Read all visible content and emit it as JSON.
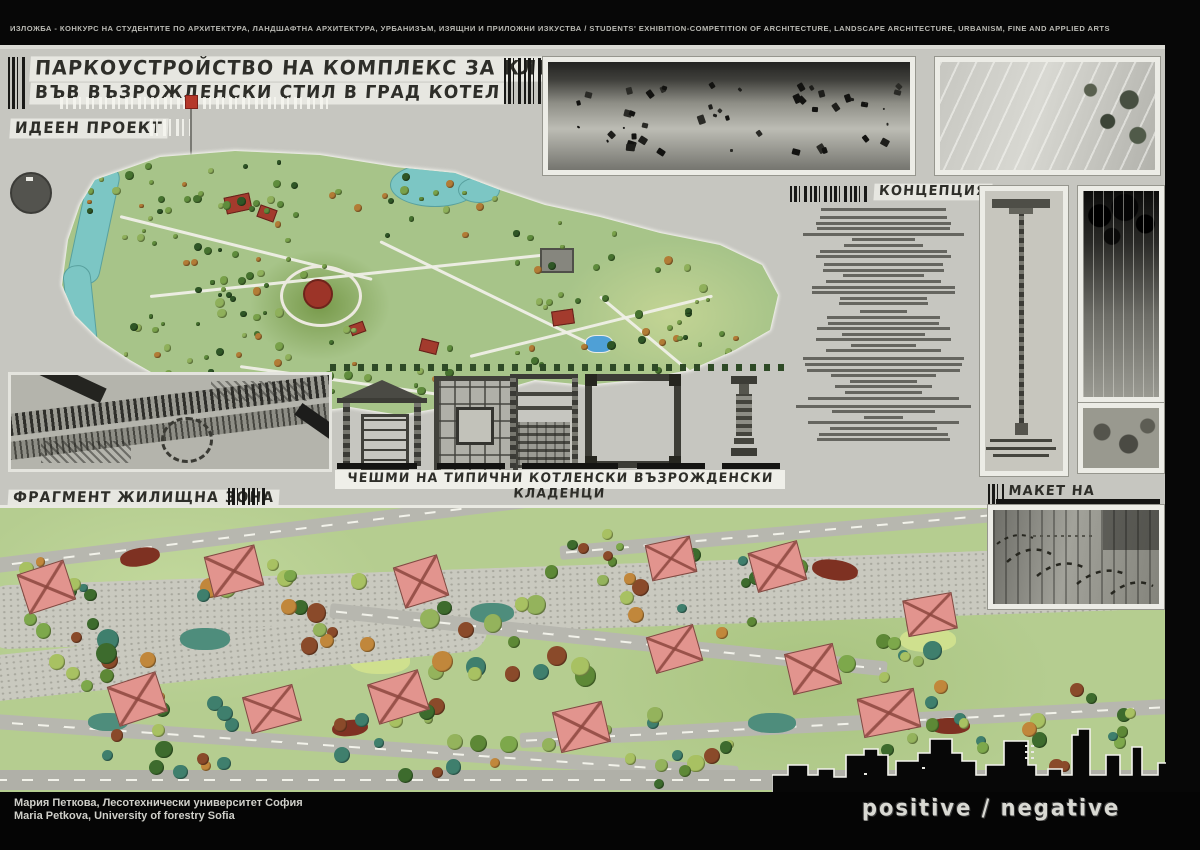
{
  "header": {
    "competition_line": "ИЗЛОЖБА - КОНКУРС НА СТУДЕНТИТЕ ПО АРХИТЕКТУРА, ЛАНДШАФТНА АРХИТЕКТУРА, УРБАНИЗЪМ, ИЗЯЩНИ И ПРИЛОЖНИ ИЗКУСТВА / STUDENTS' EXHIBITION-COMPETITION OF ARCHITECTURE, LANDSCAPE ARCHITECTURE, URBANISM, FINE AND APPLIED ARTS"
  },
  "title": {
    "line1": "ПАРКОУСТРОЙСТВО НА КОМПЛЕКС ЗА КЛИМАТОЛЕЧЕНИЕ",
    "line2": "ВЪВ ВЪЗРОЖДЕНСКИ СТИЛ В ГРАД КОТЕЛ"
  },
  "labels": {
    "master_plan": "ИДЕЕН ПРОЕКТ",
    "concept_heading": "КОНЦЕПЦИЯ",
    "wells_caption": "ЧЕШМИ НА ТИПИЧНИ КОТЛЕНСКИ ВЪЗРОЖДЕНСКИ КЛАДЕНЦИ",
    "fragment": "ФРАГМЕНТ ЖИЛИЩНА ЗОНА",
    "model": "МАКЕТ НА КОМПЛЕКСА"
  },
  "footer": {
    "author_bg": "Мария Петкова, Лесотехнически университет София",
    "author_en": "Maria Petkova, University of forestry Sofia",
    "slogan": "positive / negative"
  },
  "colors": {
    "board": "#c6c6c0",
    "plan_green": "#a7c489",
    "water_teal": "#7cc6c4",
    "pool_blue": "#4fa0d6",
    "house_pink": "#e2948e",
    "accent_red": "#b5382a",
    "road_gray": "#b7b7af",
    "ink": "#3c3c36",
    "footer_black": "#050505"
  }
}
